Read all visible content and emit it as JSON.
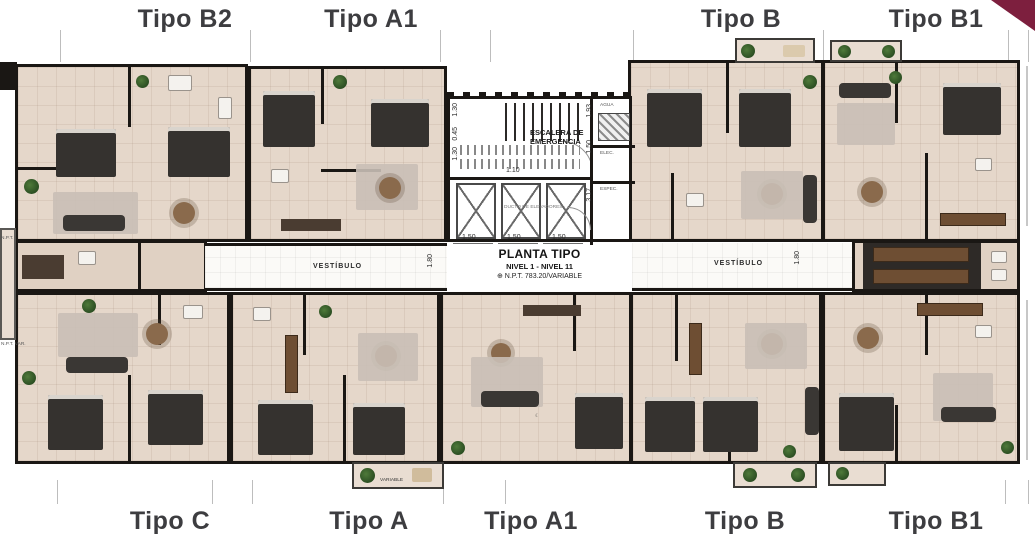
{
  "labels": {
    "top": [
      "Tipo B2",
      "Tipo A1",
      "Tipo B",
      "Tipo B1"
    ],
    "bottom": [
      "Tipo C",
      "Tipo A",
      "Tipo A1",
      "Tipo B",
      "Tipo B1"
    ]
  },
  "title_block": {
    "title": "PLANTA TIPO",
    "subtitle": "NIVEL 1 - NIVEL 11",
    "level": "⊕ N.P.T. 783.20/VARIABLE"
  },
  "corridor": {
    "left_label": "VESTÍBULO",
    "right_label": "VESTÍBULO",
    "width_dim": "1.80"
  },
  "core": {
    "stair_label_line1": "ESCALERA DE",
    "stair_label_line2": "EMERGENCIA",
    "elevator_label": "DUCTO DE ELEVADORES",
    "elevator_dims": [
      "1.50",
      "1.50",
      "1.50"
    ],
    "right_dims": [
      "1.93",
      "1.50",
      "3.17"
    ],
    "left_dims": [
      "1.30",
      "0.45",
      "1.30"
    ],
    "stair_run_dim": "1.10",
    "utility_labels": [
      "AGUA",
      "ELEC.",
      "ESPEC."
    ]
  },
  "annotations": {
    "balcony_dim": "VARIABLE",
    "npt_left_top": "N.P.T.",
    "npt_left_bottom": "N.P.T. VAR."
  },
  "colors": {
    "ribbon": "#7d1f3e",
    "label_text": "#3d3d40",
    "wall": "#1a1714",
    "floor": "#e5d7ca"
  }
}
